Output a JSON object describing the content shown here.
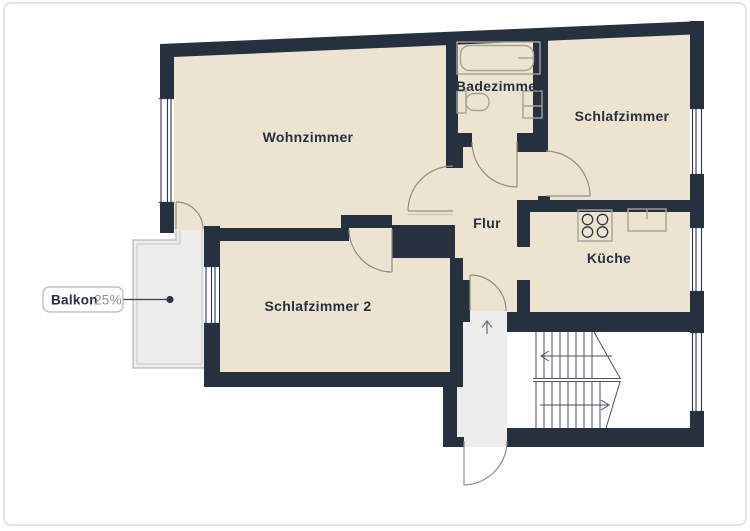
{
  "plan": {
    "title": "Grundriss",
    "rooms": [
      {
        "name": "wohnzimmer",
        "label": "Wohnzimmer"
      },
      {
        "name": "badezimmer",
        "label": "Badezimmer"
      },
      {
        "name": "schlafzimmer",
        "label": "Schlafzimmer"
      },
      {
        "name": "flur",
        "label": "Flur"
      },
      {
        "name": "kueche",
        "label": "Küche"
      },
      {
        "name": "schlafzimmer2",
        "label": "Schlafzimmer 2"
      }
    ],
    "callout": {
      "title": "Balkon",
      "value": "25%"
    },
    "fixtures": [
      "bathtub-icon",
      "toilet-icon",
      "bathroom-sink-icon",
      "stove-icon",
      "kitchen-sink-icon",
      "stairs-icon",
      "entrance-arrow-icon"
    ],
    "colors": {
      "wall": "#26303f",
      "room_fill": "#ece4d1",
      "outdoor_fill": "#ededee",
      "stairwell_fill": "#ffffff",
      "fixture_line": "#a3a29a",
      "door_line": "#8e8e86",
      "stair_line": "#4a5362",
      "text": "#27303f",
      "muted_text": "#8b909b",
      "card_border": "#dadada"
    }
  }
}
